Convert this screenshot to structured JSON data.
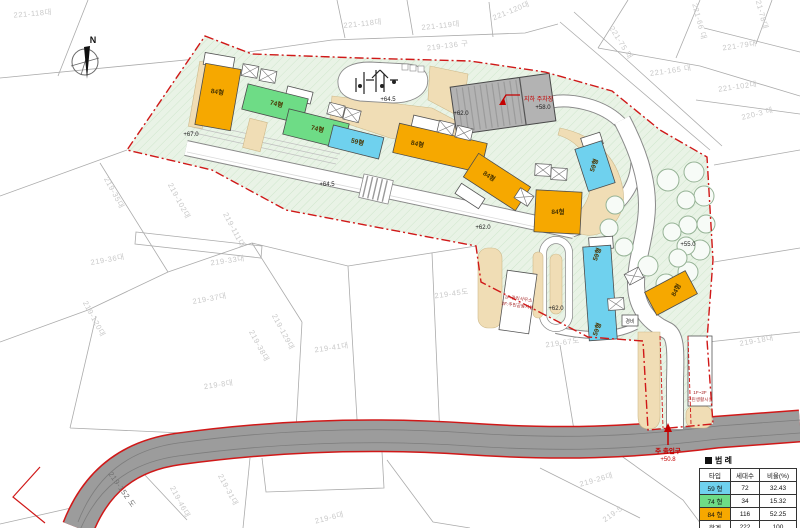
{
  "colors": {
    "type_59": "#6fd1ee",
    "type_74": "#6edc86",
    "type_84": "#f6a800",
    "site_fill": "#e9f3e6",
    "path_tan": "#f0ddb5",
    "road_gray": "#9c9c9c",
    "boundary_red": "#d01818",
    "annotation_red": "#c40000",
    "parcel_line": "#ababab",
    "parcel_text": "#c9c9c9"
  },
  "compass": {
    "label": "N"
  },
  "annotations": {
    "underground_parking": "지하 주차장",
    "main_entrance": "주 출입구",
    "main_entrance_level": "+50.8",
    "management_line1": "1F:관리사무소",
    "management_line2": "2F:주민공동시설",
    "neighborhood_line1": "1F~2F",
    "neighborhood_line2": "근린생활시설",
    "guard": "경비"
  },
  "legend": {
    "title": "범 례",
    "columns": [
      "타입",
      "세대수",
      "비율(%)"
    ],
    "rows": [
      {
        "type": "59 형",
        "color": "#6fd1ee",
        "units": "72",
        "ratio": "32.43"
      },
      {
        "type": "74 형",
        "color": "#6edc86",
        "units": "34",
        "ratio": "15.32"
      },
      {
        "type": "84 형",
        "color": "#f6a800",
        "units": "116",
        "ratio": "52.25"
      },
      {
        "type": "합계",
        "color": "",
        "units": "222",
        "ratio": "100"
      }
    ]
  },
  "labels": {
    "parcels": [
      {
        "text": "221-118대",
        "x": 33,
        "y": 16,
        "r": -5
      },
      {
        "text": "221-118대",
        "x": 363,
        "y": 26,
        "r": -6
      },
      {
        "text": "221-119대",
        "x": 441,
        "y": 28,
        "r": -6
      },
      {
        "text": "221-120대",
        "x": 512,
        "y": 13,
        "r": -22
      },
      {
        "text": "219-136 구",
        "x": 448,
        "y": 48,
        "r": -7
      },
      {
        "text": "221-75 대",
        "x": 619,
        "y": 44,
        "r": 58
      },
      {
        "text": "221-66 대",
        "x": 697,
        "y": 22,
        "r": 75
      },
      {
        "text": "221-78대",
        "x": 759,
        "y": 13,
        "r": 75
      },
      {
        "text": "221-79대",
        "x": 740,
        "y": 48,
        "r": -8
      },
      {
        "text": "221-165 대",
        "x": 671,
        "y": 73,
        "r": -8
      },
      {
        "text": "221-102대",
        "x": 738,
        "y": 89,
        "r": -8
      },
      {
        "text": "220-3 대",
        "x": 758,
        "y": 116,
        "r": -14
      },
      {
        "text": "219-35대",
        "x": 112,
        "y": 194,
        "r": 62
      },
      {
        "text": "219-102대",
        "x": 177,
        "y": 202,
        "r": 62
      },
      {
        "text": "219-111대",
        "x": 232,
        "y": 231,
        "r": 62
      },
      {
        "text": "219-36대",
        "x": 108,
        "y": 262,
        "r": -10
      },
      {
        "text": "219-33대",
        "x": 228,
        "y": 263,
        "r": -8
      },
      {
        "text": "219-37대",
        "x": 210,
        "y": 301,
        "r": -10
      },
      {
        "text": "219-45도",
        "x": 452,
        "y": 296,
        "r": -8
      },
      {
        "text": "219-129대",
        "x": 281,
        "y": 333,
        "r": 62
      },
      {
        "text": "219-38대",
        "x": 257,
        "y": 347,
        "r": 62
      },
      {
        "text": "219-41대",
        "x": 332,
        "y": 350,
        "r": -8
      },
      {
        "text": "219-67도",
        "x": 563,
        "y": 345,
        "r": -8
      },
      {
        "text": "219-8대",
        "x": 219,
        "y": 387,
        "r": -8
      },
      {
        "text": "219-120대",
        "x": 92,
        "y": 320,
        "r": 62
      },
      {
        "text": "219-31대",
        "x": 226,
        "y": 491,
        "r": 62
      },
      {
        "text": "219-46대",
        "x": 178,
        "y": 503,
        "r": 62
      },
      {
        "text": "219-6대",
        "x": 330,
        "y": 520,
        "r": -14
      },
      {
        "text": "219-26대",
        "x": 597,
        "y": 482,
        "r": -16
      },
      {
        "text": "219-5",
        "x": 614,
        "y": 516,
        "r": -35
      },
      {
        "text": "219-18대",
        "x": 757,
        "y": 343,
        "r": -10
      },
      {
        "text": "219-152 도",
        "x": 120,
        "y": 491,
        "r": 55,
        "dark": true
      }
    ],
    "elevations": [
      {
        "text": "+64.5",
        "x": 388,
        "y": 101
      },
      {
        "text": "+62.0",
        "x": 461,
        "y": 115
      },
      {
        "text": "+58.0",
        "x": 543,
        "y": 109
      },
      {
        "text": "+67.0",
        "x": 191,
        "y": 136
      },
      {
        "text": "+64.5",
        "x": 327,
        "y": 186
      },
      {
        "text": "+62.0",
        "x": 483,
        "y": 229
      },
      {
        "text": "+55.0",
        "x": 688,
        "y": 246
      },
      {
        "text": "+62.0",
        "x": 556,
        "y": 310
      }
    ],
    "buildings": [
      {
        "text": "84형",
        "x": 217,
        "y": 94,
        "r": 10
      },
      {
        "text": "74형",
        "x": 276,
        "y": 106,
        "r": 14
      },
      {
        "text": "74형",
        "x": 317,
        "y": 131,
        "r": 14
      },
      {
        "text": "59형",
        "x": 357,
        "y": 144,
        "r": 14
      },
      {
        "text": "84형",
        "x": 417,
        "y": 146,
        "r": 13
      },
      {
        "text": "84형",
        "x": 488,
        "y": 178,
        "r": 33
      },
      {
        "text": "84형",
        "x": 558,
        "y": 214,
        "r": 0
      },
      {
        "text": "59형",
        "x": 596,
        "y": 166,
        "r": -70
      },
      {
        "text": "59형",
        "x": 599,
        "y": 255,
        "r": -70
      },
      {
        "text": "59형",
        "x": 599,
        "y": 330,
        "r": -70
      },
      {
        "text": "84형",
        "x": 678,
        "y": 291,
        "r": -62
      }
    ]
  }
}
